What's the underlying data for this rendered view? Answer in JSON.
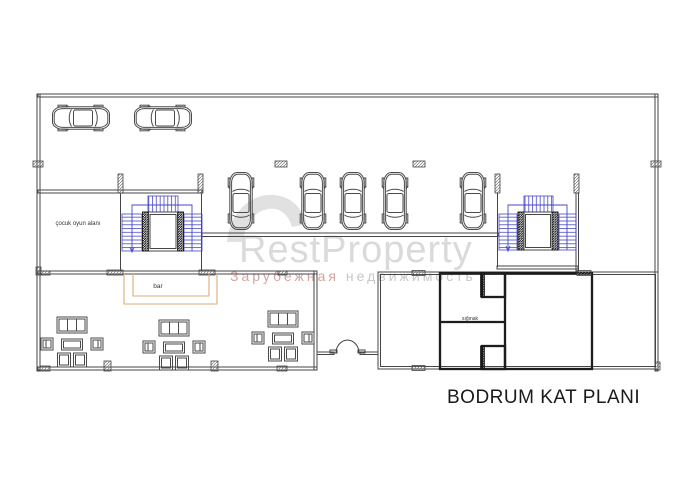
{
  "title": {
    "text": "BODRUM KAT PLANI"
  },
  "labels": {
    "play_area": "çocuk oyun alanı",
    "bar": "bar",
    "shelter": "sığınak"
  },
  "watermark": {
    "brand": "RestProperty",
    "subtitle_left": "Зарубежная",
    "subtitle_right": " недвижимость"
  },
  "colors": {
    "line": "#454545",
    "stair_blue": "#4646c8",
    "bar_tan": "#dcae76",
    "watermark_gray": "#dadada",
    "subtitle_pink": "#d2a4a4",
    "subtitle_gray": "#c6c6cb",
    "title_color": "#1a1a1a"
  },
  "plan": {
    "cars_horizontal": [
      {
        "x": 50,
        "y": 105
      },
      {
        "x": 132,
        "y": 105
      }
    ],
    "cars_vertical": [
      {
        "x": 228,
        "y": 170
      },
      {
        "x": 300,
        "y": 170
      },
      {
        "x": 340,
        "y": 170
      },
      {
        "x": 382,
        "y": 170
      },
      {
        "x": 460,
        "y": 170
      }
    ],
    "seating_groups": [
      {
        "cx": 72,
        "cy": 344
      },
      {
        "cx": 174,
        "cy": 347
      },
      {
        "cx": 283,
        "cy": 338
      }
    ]
  }
}
